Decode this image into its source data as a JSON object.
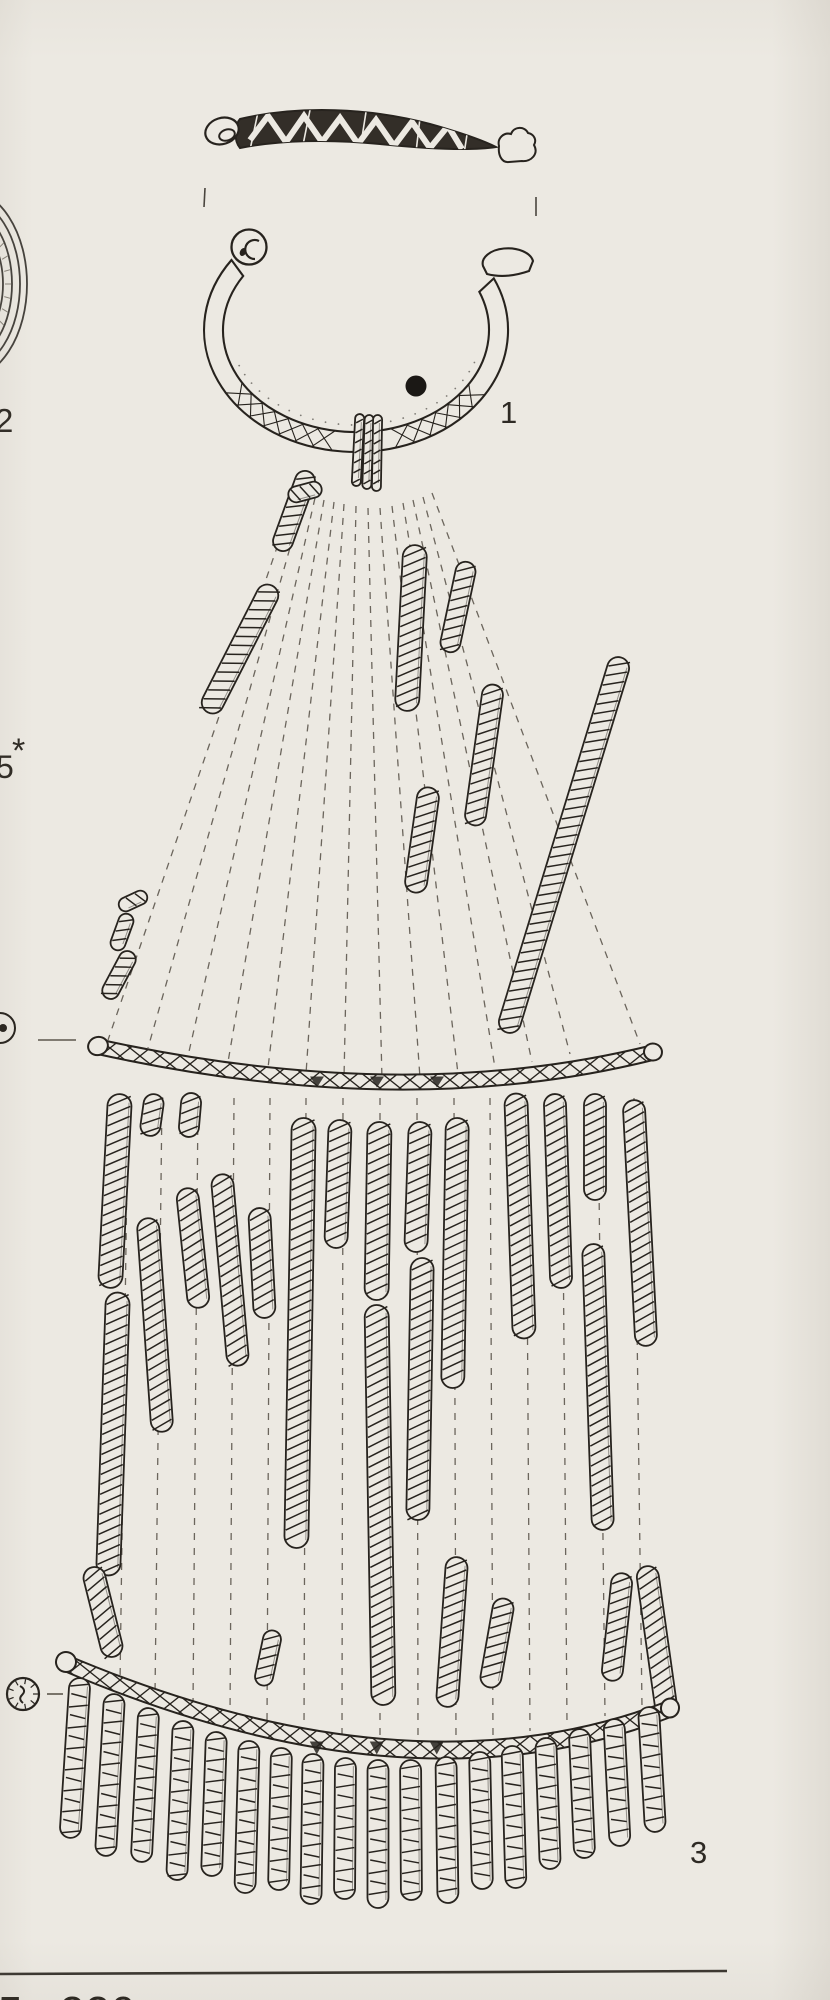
{
  "palette": {
    "paper": "#ece9e2",
    "ink": "#27231e",
    "ink_soft": "#5d574d",
    "dot_fill": "#1b1815",
    "label_color": "#2e2a24"
  },
  "labels": {
    "ring_item": "1",
    "disc_item": "2",
    "fringe_item": "3",
    "grave_number": "5",
    "grave_mark": "*",
    "page_caption": "5. 220"
  },
  "drawing": {
    "fan_coils": [
      {
        "x": 294,
        "y": 511,
        "l": 84,
        "w": 20,
        "a": 20
      },
      {
        "x": 240,
        "y": 649,
        "l": 142,
        "w": 22,
        "a": 27
      },
      {
        "x": 411,
        "y": 628,
        "l": 166,
        "w": 24,
        "a": 3
      },
      {
        "x": 458,
        "y": 607,
        "l": 92,
        "w": 20,
        "a": 12
      },
      {
        "x": 484,
        "y": 755,
        "l": 142,
        "w": 21,
        "a": 8
      },
      {
        "x": 564,
        "y": 845,
        "l": 392,
        "w": 22,
        "a": 17
      },
      {
        "x": 422,
        "y": 840,
        "l": 106,
        "w": 22,
        "a": 8
      },
      {
        "x": 305,
        "y": 492,
        "l": 34,
        "w": 16,
        "a": 75
      },
      {
        "x": 133,
        "y": 901,
        "l": 30,
        "w": 14,
        "a": 65
      },
      {
        "x": 122,
        "y": 932,
        "l": 38,
        "w": 15,
        "a": 20
      },
      {
        "x": 119,
        "y": 975,
        "l": 52,
        "w": 17,
        "a": 28
      }
    ],
    "mid_coils": [
      {
        "x": 115,
        "y": 1191,
        "l": 194,
        "w": 24,
        "a": 3
      },
      {
        "x": 113,
        "y": 1434,
        "l": 283,
        "w": 24,
        "a": 2
      },
      {
        "x": 103,
        "y": 1612,
        "l": 92,
        "w": 22,
        "a": -14
      },
      {
        "x": 152,
        "y": 1115,
        "l": 42,
        "w": 20,
        "a": 8
      },
      {
        "x": 155,
        "y": 1325,
        "l": 214,
        "w": 22,
        "a": -4
      },
      {
        "x": 190,
        "y": 1115,
        "l": 44,
        "w": 20,
        "a": 5
      },
      {
        "x": 193,
        "y": 1248,
        "l": 120,
        "w": 22,
        "a": -6
      },
      {
        "x": 230,
        "y": 1270,
        "l": 192,
        "w": 22,
        "a": -5
      },
      {
        "x": 262,
        "y": 1263,
        "l": 110,
        "w": 22,
        "a": -3
      },
      {
        "x": 300,
        "y": 1333,
        "l": 430,
        "w": 24,
        "a": 1
      },
      {
        "x": 338,
        "y": 1184,
        "l": 128,
        "w": 23,
        "a": 2
      },
      {
        "x": 378,
        "y": 1211,
        "l": 178,
        "w": 24,
        "a": 1
      },
      {
        "x": 380,
        "y": 1505,
        "l": 400,
        "w": 24,
        "a": -1
      },
      {
        "x": 418,
        "y": 1187,
        "l": 130,
        "w": 23,
        "a": 2
      },
      {
        "x": 420,
        "y": 1389,
        "l": 262,
        "w": 23,
        "a": 1
      },
      {
        "x": 455,
        "y": 1253,
        "l": 270,
        "w": 23,
        "a": 1
      },
      {
        "x": 452,
        "y": 1632,
        "l": 150,
        "w": 22,
        "a": 4
      },
      {
        "x": 497,
        "y": 1643,
        "l": 90,
        "w": 21,
        "a": 10
      },
      {
        "x": 520,
        "y": 1216,
        "l": 245,
        "w": 23,
        "a": -2
      },
      {
        "x": 558,
        "y": 1191,
        "l": 194,
        "w": 22,
        "a": -2
      },
      {
        "x": 595,
        "y": 1147,
        "l": 106,
        "w": 22,
        "a": 0
      },
      {
        "x": 598,
        "y": 1387,
        "l": 286,
        "w": 22,
        "a": -2
      },
      {
        "x": 640,
        "y": 1223,
        "l": 246,
        "w": 22,
        "a": -3
      },
      {
        "x": 657,
        "y": 1642,
        "l": 153,
        "w": 22,
        "a": -8
      },
      {
        "x": 268,
        "y": 1658,
        "l": 56,
        "w": 18,
        "a": 12
      },
      {
        "x": 617,
        "y": 1627,
        "l": 108,
        "w": 21,
        "a": 6
      }
    ],
    "wrap_loops": [
      {
        "x": 358,
        "y": 450,
        "l": 72,
        "w": 9,
        "a": 3
      },
      {
        "x": 368,
        "y": 452,
        "l": 74,
        "w": 9,
        "a": 2
      },
      {
        "x": 377,
        "y": 453,
        "l": 76,
        "w": 9,
        "a": 1
      }
    ],
    "fan_lines": [
      [
        296,
        492,
        108,
        1040
      ],
      [
        305,
        495,
        148,
        1048
      ],
      [
        315,
        498,
        188,
        1056
      ],
      [
        324,
        500,
        228,
        1062
      ],
      [
        334,
        502,
        268,
        1068
      ],
      [
        344,
        504,
        306,
        1074
      ],
      [
        356,
        506,
        344,
        1078
      ],
      [
        368,
        508,
        382,
        1080
      ],
      [
        380,
        508,
        420,
        1078
      ],
      [
        392,
        506,
        458,
        1074
      ],
      [
        403,
        503,
        495,
        1068
      ],
      [
        413,
        500,
        532,
        1062
      ],
      [
        423,
        497,
        570,
        1054
      ],
      [
        432,
        493,
        640,
        1044
      ]
    ],
    "mid_lines": [
      [
        128,
        1098,
        120,
        1684
      ],
      [
        162,
        1098,
        155,
        1695
      ],
      [
        198,
        1098,
        193,
        1706
      ],
      [
        234,
        1098,
        230,
        1716
      ],
      [
        270,
        1098,
        267,
        1724
      ],
      [
        306,
        1098,
        304,
        1731
      ],
      [
        343,
        1098,
        342,
        1736
      ],
      [
        380,
        1098,
        380,
        1739
      ],
      [
        417,
        1098,
        418,
        1740
      ],
      [
        454,
        1098,
        456,
        1739
      ],
      [
        490,
        1098,
        493,
        1736
      ],
      [
        526,
        1098,
        530,
        1731
      ],
      [
        562,
        1098,
        567,
        1724
      ],
      [
        598,
        1098,
        605,
        1716
      ],
      [
        634,
        1098,
        642,
        1707
      ]
    ],
    "fringe_columns": [
      {
        "x": 75,
        "t": 1678,
        "b": 1838
      },
      {
        "x": 110,
        "t": 1694,
        "b": 1856
      },
      {
        "x": 145,
        "t": 1708,
        "b": 1862
      },
      {
        "x": 180,
        "t": 1721,
        "b": 1880
      },
      {
        "x": 214,
        "t": 1732,
        "b": 1876
      },
      {
        "x": 247,
        "t": 1741,
        "b": 1893
      },
      {
        "x": 280,
        "t": 1748,
        "b": 1890
      },
      {
        "x": 312,
        "t": 1754,
        "b": 1904
      },
      {
        "x": 345,
        "t": 1758,
        "b": 1899
      },
      {
        "x": 378,
        "t": 1760,
        "b": 1908
      },
      {
        "x": 411,
        "t": 1760,
        "b": 1900
      },
      {
        "x": 447,
        "t": 1757,
        "b": 1903
      },
      {
        "x": 481,
        "t": 1752,
        "b": 1889
      },
      {
        "x": 514,
        "t": 1746,
        "b": 1888
      },
      {
        "x": 548,
        "t": 1738,
        "b": 1869
      },
      {
        "x": 582,
        "t": 1729,
        "b": 1858
      },
      {
        "x": 617,
        "t": 1719,
        "b": 1846
      },
      {
        "x": 652,
        "t": 1707,
        "b": 1832
      }
    ],
    "bar1": {
      "x1": 95,
      "y1": 1046,
      "cx": 405,
      "cy": 1115,
      "x2": 655,
      "y2": 1052,
      "h": 7.5
    },
    "bar2": {
      "x1": 63,
      "y1": 1662,
      "cx": 412,
      "cy": 1811,
      "x2": 672,
      "y2": 1708,
      "h": 8.5
    },
    "reg_marks": [
      [
        205,
        188,
        204,
        207
      ],
      [
        536,
        197,
        536,
        216
      ]
    ],
    "ring": {
      "cx": 356,
      "cy": 330,
      "rox": 152,
      "roy": 122,
      "rix": 133,
      "riy": 102,
      "dot_x": 416,
      "dot_y": 386,
      "dot_r": 10.5
    },
    "disc_arcs": [
      [
        62,
        95
      ],
      [
        55,
        86
      ],
      [
        47,
        76
      ],
      [
        38,
        63
      ]
    ],
    "icon1": {
      "cx": 0,
      "cy": 1028,
      "r": 15,
      "dash": [
        38,
        1040,
        76,
        1040
      ]
    },
    "icon2": {
      "cx": 23,
      "cy": 1694,
      "r": 16,
      "dash": [
        47,
        1694,
        63,
        1694
      ]
    },
    "rule_line": [
      0,
      1974,
      727,
      1971
    ]
  }
}
